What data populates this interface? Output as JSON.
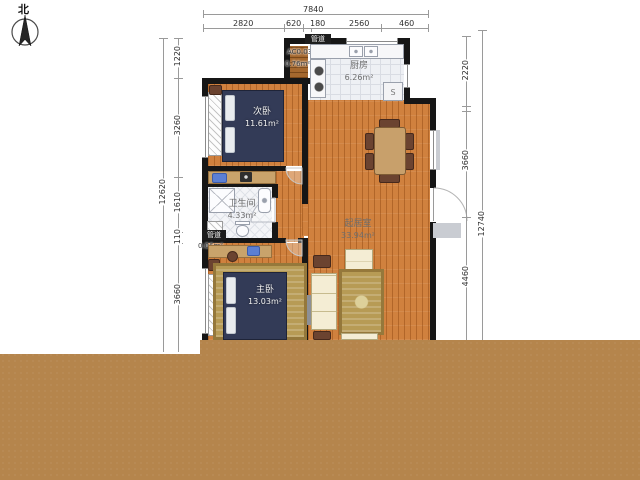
{
  "compass": {
    "north": "北"
  },
  "dimensions": {
    "top": {
      "total": "7840",
      "segments": [
        "2820",
        "620",
        "180",
        "2560",
        "460"
      ]
    },
    "left": {
      "total": "12620",
      "segments": [
        "1220",
        "3260",
        "1610",
        "110",
        "3660"
      ]
    },
    "right": {
      "total": "12740",
      "segments": [
        "2220",
        "3660",
        "4460"
      ]
    }
  },
  "rooms": {
    "secondary_bedroom": {
      "name": "次卧",
      "area": "11.61m²"
    },
    "kitchen": {
      "name": "厨房",
      "area": "6.26m²"
    },
    "bathroom": {
      "name": "卫生间",
      "area": "4.33m²"
    },
    "master_bedroom": {
      "name": "主卧",
      "area": "13.03m²"
    },
    "living_room": {
      "name": "起居室",
      "area": "33.94m²"
    }
  },
  "annotations": {
    "duct_top": {
      "tag": "管道",
      "line1": "AC0.03m²",
      "line2": "0.76m²"
    },
    "duct_bottom": {
      "tag": "管道",
      "area": "0.06m²"
    },
    "appliance_label": "S"
  },
  "colors": {
    "wall": "#161616",
    "wood_floor": "#d0813e",
    "tile": "#eef0f4",
    "bottom_band": "#b5854c",
    "bed": "#333b57",
    "rug_gold": "#b79b55",
    "sofa_cream": "#f4edd4",
    "appliance_blue": "#5b7fd4"
  }
}
